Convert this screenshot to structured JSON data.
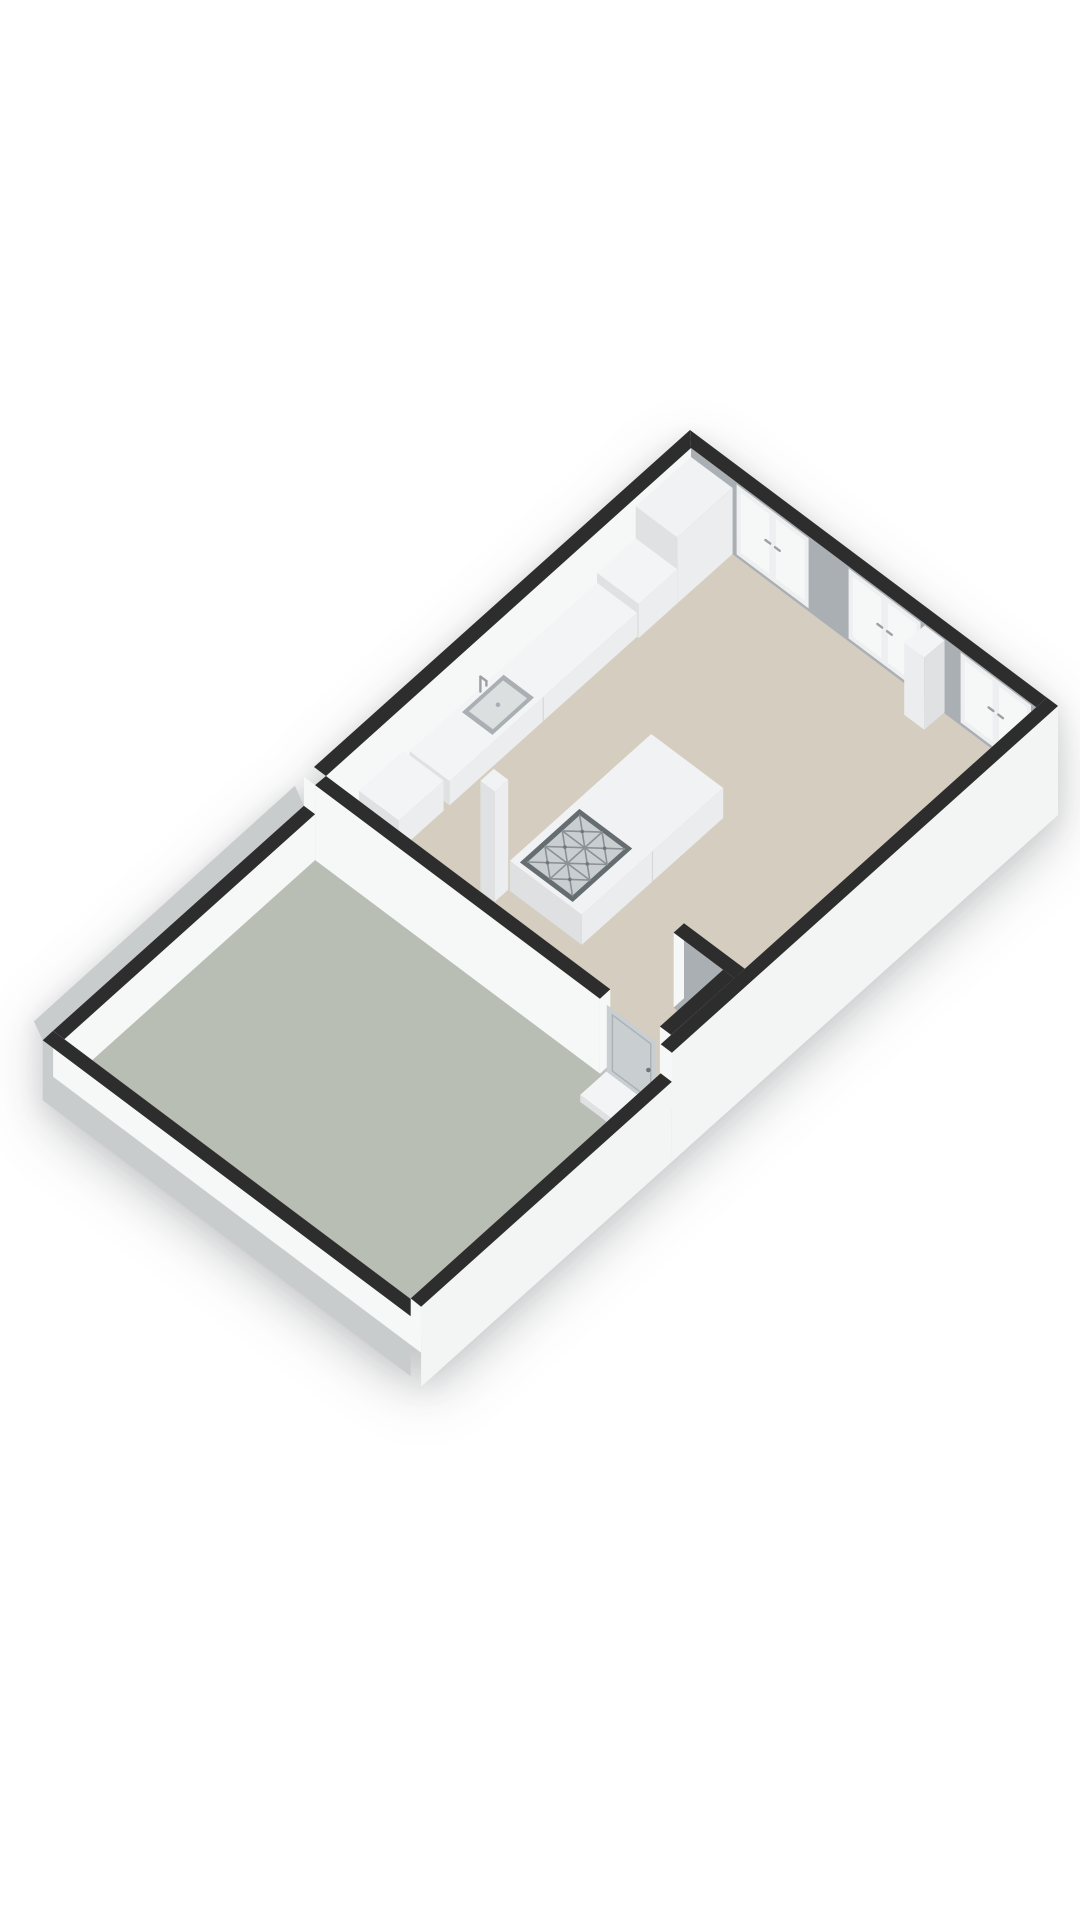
{
  "page": {
    "kind": "3d-floorplan-render",
    "background": "#ffffff"
  },
  "colors": {
    "background": "#ffffff",
    "wallCap": "#2d2d2d",
    "floorMain": "#d5cdbf",
    "floorTerrace": "#b9beb5",
    "wallWhite": "#f6f7f7",
    "wallWhiteShade": "#eceeee",
    "neWallGray": "#a9afb3",
    "outerGray": "#c9cccd",
    "seWallOuter": "#f3f4f4",
    "counterTop": "#f3f4f5",
    "counterFront": "#ebedee",
    "counterSide": "#dfe1e2",
    "islandTop": "#f1f2f3",
    "islandFront": "#eaeced",
    "islandSide": "#dee0e1",
    "cooktopFrame": "#666d71",
    "cooktopPanel": "#c9ced0",
    "grate": "#8a9094",
    "grateDot": "#6f7579",
    "windowFrame": "#edeff0",
    "windowGlass": "#f6f8f8",
    "handleMetal": "#9aa0a4",
    "doorLeaf": "#c9ced1",
    "doorLine": "#aab0b4",
    "sinkRim": "#a9afb3",
    "sinkBasin": "#dcdfe0",
    "seamLine": "#d6d9da"
  },
  "plan": {
    "projection": "axonometric-3d",
    "rooms": [
      {
        "id": "living-kitchen",
        "floor": "beige",
        "walls_cut": true,
        "features": [
          "kitchen-counter",
          "sink-with-faucet",
          "tall-cabinet",
          "kitchen-island",
          "gas-cooktop",
          "structural-column",
          "french-door-windows"
        ]
      },
      {
        "id": "terrace",
        "floor": "gray-green",
        "walls": "low-parapets",
        "features": [
          "entry-step"
        ]
      },
      {
        "id": "entry-vestibule",
        "floor": "beige",
        "features": [
          "entry-door",
          "closet-walls"
        ]
      }
    ],
    "fixtures": {
      "cooktop_burners": 6,
      "window_sets": 3,
      "panels_per_window": 2,
      "sinks": 1,
      "entry_doors": 1,
      "steps": 1
    }
  }
}
